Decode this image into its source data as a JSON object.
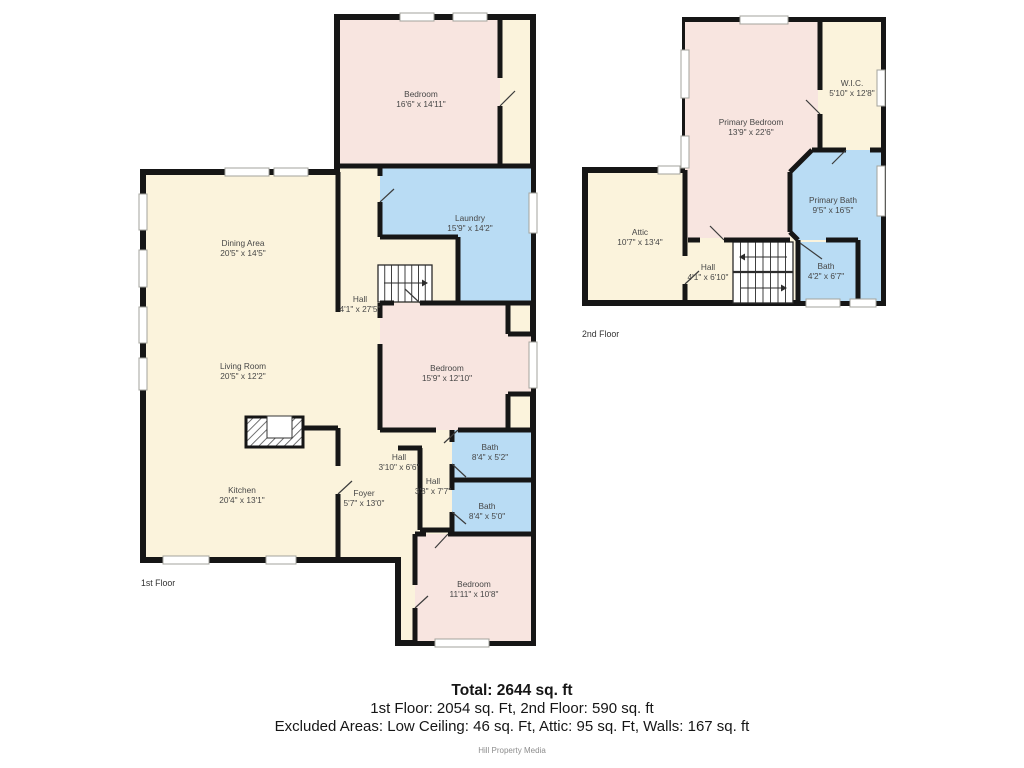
{
  "summary": {
    "total": "Total: 2644 sq. ft",
    "floors": "1st Floor: 2054 sq. Ft, 2nd Floor: 590 sq. ft",
    "excluded": "Excluded Areas: Low Ceiling: 46 sq. Ft, Attic: 95 sq. Ft, Walls: 167 sq. ft",
    "credit": "Hill Property Media"
  },
  "floorplan": {
    "colors": {
      "cream": "#fbf3dc",
      "pink": "#f8e5e0",
      "blue": "#b9dcf4",
      "wall": "#161616"
    },
    "floors": [
      {
        "slug": "1st-floor",
        "label": "1st Floor",
        "label_pos": [
          141,
          586
        ],
        "footprint": [
          [
            337,
            17
          ],
          [
            533,
            17
          ],
          [
            533,
            643
          ],
          [
            398,
            643
          ],
          [
            398,
            560
          ],
          [
            143,
            560
          ],
          [
            143,
            172
          ],
          [
            337,
            172
          ]
        ],
        "rooms": [
          {
            "id": "bedroom-1",
            "name": "Bedroom",
            "dims": "16'6\" x 14'11\"",
            "fill": "pink",
            "rect": [
              340,
              20,
              160,
              146
            ],
            "label": [
              421,
              97
            ]
          },
          {
            "id": "laundry",
            "name": "Laundry",
            "dims": "15'9\" x 14'2\"",
            "fill": "blue",
            "poly": [
              [
                380,
                166
              ],
              [
                531,
                166
              ],
              [
                531,
                303
              ],
              [
                458,
                303
              ],
              [
                458,
                237
              ],
              [
                380,
                237
              ]
            ],
            "label": [
              470,
              221
            ]
          },
          {
            "id": "bedroom-2",
            "name": "Bedroom",
            "dims": "15'9\" x 12'10\"",
            "fill": "pink",
            "poly": [
              [
                380,
                303
              ],
              [
                508,
                303
              ],
              [
                508,
                334
              ],
              [
                531,
                334
              ],
              [
                531,
                394
              ],
              [
                508,
                394
              ],
              [
                508,
                430
              ],
              [
                380,
                430
              ]
            ],
            "label": [
              447,
              371
            ]
          },
          {
            "id": "bath-1",
            "name": "Bath",
            "dims": "8'4\" x 5'2\"",
            "fill": "blue",
            "rect": [
              452,
              430,
              79,
              50
            ],
            "label": [
              490,
              450
            ]
          },
          {
            "id": "bath-2",
            "name": "Bath",
            "dims": "8'4\" x 5'0\"",
            "fill": "blue",
            "rect": [
              452,
              480,
              79,
              54
            ],
            "label": [
              487,
              509
            ]
          },
          {
            "id": "bedroom-3",
            "name": "Bedroom",
            "dims": "11'11\" x 10'8\"",
            "fill": "pink",
            "rect": [
              415,
              534,
              116,
              107
            ],
            "label": [
              474,
              587
            ]
          },
          {
            "id": "dining-area",
            "name": "Dining Area",
            "dims": "20'5\" x 14'5\"",
            "label": [
              243,
              246
            ]
          },
          {
            "id": "living-room",
            "name": "Living Room",
            "dims": "20'5\" x 12'2\"",
            "label": [
              243,
              369
            ]
          },
          {
            "id": "kitchen",
            "name": "Kitchen",
            "dims": "20'4\" x 13'1\"",
            "label": [
              242,
              493
            ]
          },
          {
            "id": "hall-main",
            "name": "Hall",
            "dims": "4'1\" x 27'5\"",
            "label": [
              360,
              302
            ]
          },
          {
            "id": "hall-2",
            "name": "Hall",
            "dims": "3'10\" x 6'6\"",
            "label": [
              399,
              460
            ]
          },
          {
            "id": "hall-3",
            "name": "Hall",
            "dims": "3'3\" x 7'7\"",
            "label": [
              433,
              484
            ]
          },
          {
            "id": "foyer",
            "name": "Foyer",
            "dims": "5'7\" x 13'0\"",
            "label": [
              364,
              496
            ]
          }
        ],
        "walls": [
          [
            337,
            166,
            533,
            166
          ],
          [
            500,
            20,
            500,
            78
          ],
          [
            500,
            106,
            500,
            166
          ],
          [
            380,
            166,
            380,
            176
          ],
          [
            380,
            202,
            380,
            237
          ],
          [
            380,
            237,
            458,
            237
          ],
          [
            458,
            237,
            458,
            303
          ],
          [
            380,
            303,
            394,
            303
          ],
          [
            420,
            303,
            531,
            303
          ],
          [
            380,
            303,
            380,
            318
          ],
          [
            380,
            344,
            380,
            430
          ],
          [
            338,
            172,
            338,
            312
          ],
          [
            303,
            428,
            338,
            428
          ],
          [
            338,
            428,
            338,
            466
          ],
          [
            338,
            494,
            338,
            560
          ],
          [
            380,
            430,
            436,
            430
          ],
          [
            458,
            430,
            531,
            430
          ],
          [
            452,
            430,
            452,
            442
          ],
          [
            452,
            464,
            452,
            490
          ],
          [
            452,
            512,
            452,
            534
          ],
          [
            452,
            480,
            531,
            480
          ],
          [
            398,
            448,
            422,
            448
          ],
          [
            420,
            448,
            420,
            530
          ],
          [
            420,
            530,
            452,
            530
          ],
          [
            508,
            303,
            508,
            334
          ],
          [
            508,
            334,
            531,
            334
          ],
          [
            508,
            394,
            531,
            394
          ],
          [
            508,
            394,
            508,
            430
          ],
          [
            415,
            534,
            426,
            534
          ],
          [
            448,
            534,
            531,
            534
          ],
          [
            415,
            534,
            415,
            585
          ],
          [
            415,
            608,
            415,
            641
          ]
        ],
        "windows": [
          [
            400,
            13,
            34,
            8
          ],
          [
            453,
            13,
            34,
            8
          ],
          [
            225,
            168,
            44,
            8
          ],
          [
            274,
            168,
            34,
            8
          ],
          [
            139,
            194,
            8,
            36
          ],
          [
            139,
            250,
            8,
            37
          ],
          [
            139,
            307,
            8,
            36
          ],
          [
            139,
            358,
            8,
            32
          ],
          [
            163,
            556,
            46,
            8
          ],
          [
            266,
            556,
            30,
            8
          ],
          [
            435,
            639,
            54,
            8
          ],
          [
            529,
            193,
            8,
            40
          ],
          [
            529,
            342,
            8,
            46
          ]
        ],
        "doors": [
          [
            500,
            106,
            515,
            91
          ],
          [
            420,
            303,
            405,
            289
          ],
          [
            458,
            430,
            444,
            443
          ],
          [
            452,
            464,
            466,
            477
          ],
          [
            452,
            512,
            466,
            524
          ],
          [
            448,
            534,
            435,
            548
          ],
          [
            380,
            202,
            394,
            189
          ],
          [
            338,
            494,
            352,
            481
          ],
          [
            415,
            608,
            428,
            596
          ]
        ],
        "stairs": [
          {
            "box": [
              378,
              265,
              54,
              37
            ],
            "treads": 7,
            "arrows": [
              {
                "from": [
                  384,
                  283
                ],
                "to": [
                  422,
                  283
                ]
              }
            ]
          }
        ],
        "fireplace": {
          "rect": [
            246,
            417,
            57,
            30
          ],
          "notch": [
            267,
            416,
            25,
            22
          ]
        }
      },
      {
        "slug": "2nd-floor",
        "label": "2nd Floor",
        "label_pos": [
          582,
          337
        ],
        "footprint": [
          [
            685,
            20
          ],
          [
            883,
            20
          ],
          [
            883,
            303
          ],
          [
            585,
            303
          ],
          [
            585,
            170
          ],
          [
            685,
            170
          ]
        ],
        "rooms": [
          {
            "id": "primary-bedroom",
            "name": "Primary Bedroom",
            "dims": "13'9\" x 22'6\"",
            "fill": "pink",
            "poly": [
              [
                685,
                22
              ],
              [
                818,
                22
              ],
              [
                818,
                150
              ],
              [
                812,
                150
              ],
              [
                790,
                172
              ],
              [
                790,
                238
              ],
              [
                685,
                238
              ]
            ],
            "label": [
              751,
              125
            ]
          },
          {
            "id": "wic",
            "name": "W.I.C.",
            "dims": "5'10\" x 12'8\"",
            "fill": "cream",
            "rect": [
              822,
              22,
              59,
              126
            ],
            "label": [
              852,
              86
            ]
          },
          {
            "id": "primary-bath",
            "name": "Primary Bath",
            "dims": "9'5\" x 16'5\"",
            "fill": "blue",
            "poly": [
              [
                815,
                150
              ],
              [
                881,
                150
              ],
              [
                881,
                301
              ],
              [
                860,
                301
              ],
              [
                860,
                240
              ],
              [
                798,
                240
              ],
              [
                790,
                231
              ],
              [
                790,
                173
              ]
            ],
            "label": [
              833,
              203
            ]
          },
          {
            "id": "bath-3",
            "name": "Bath",
            "dims": "4'2\" x 6'7\"",
            "fill": "blue",
            "rect": [
              800,
              242,
              58,
              59
            ],
            "label": [
              826,
              269
            ]
          },
          {
            "id": "attic",
            "name": "Attic",
            "dims": "10'7\" x 13'4\"",
            "label": [
              640,
              235
            ]
          },
          {
            "id": "hall-4",
            "name": "Hall",
            "dims": "4'1\" x 6'10\"",
            "label": [
              708,
              270
            ]
          }
        ],
        "walls": [
          [
            685,
            170,
            685,
            256
          ],
          [
            685,
            284,
            685,
            303
          ],
          [
            820,
            22,
            820,
            90
          ],
          [
            820,
            114,
            820,
            150
          ],
          [
            812,
            150,
            846,
            150
          ],
          [
            870,
            150,
            881,
            150
          ],
          [
            812,
            150,
            790,
            172
          ],
          [
            790,
            172,
            790,
            232
          ],
          [
            790,
            232,
            798,
            240
          ],
          [
            798,
            240,
            798,
            303
          ],
          [
            826,
            240,
            858,
            240
          ],
          [
            858,
            240,
            858,
            303
          ],
          [
            688,
            240,
            700,
            240
          ],
          [
            724,
            240,
            790,
            240
          ]
        ],
        "windows": [
          [
            740,
            16,
            48,
            8
          ],
          [
            681,
            50,
            8,
            48
          ],
          [
            681,
            136,
            8,
            32
          ],
          [
            658,
            166,
            22,
            8
          ],
          [
            877,
            70,
            8,
            36
          ],
          [
            877,
            166,
            8,
            50
          ],
          [
            806,
            299,
            34,
            8
          ],
          [
            850,
            299,
            26,
            8
          ]
        ],
        "doors": [
          [
            685,
            284,
            699,
            271
          ],
          [
            820,
            114,
            806,
            100
          ],
          [
            724,
            240,
            710,
            226
          ],
          [
            800,
            243,
            822,
            259
          ],
          [
            846,
            150,
            832,
            164
          ]
        ],
        "stairs": [
          {
            "box": [
              733,
              242,
              60,
              61
            ],
            "treads": 7,
            "rail": 272,
            "arrows": [
              {
                "from": [
                  787,
                  257
                ],
                "to": [
                  745,
                  257
                ]
              },
              {
                "from": [
                  741,
                  288
                ],
                "to": [
                  781,
                  288
                ]
              }
            ]
          }
        ]
      }
    ]
  }
}
